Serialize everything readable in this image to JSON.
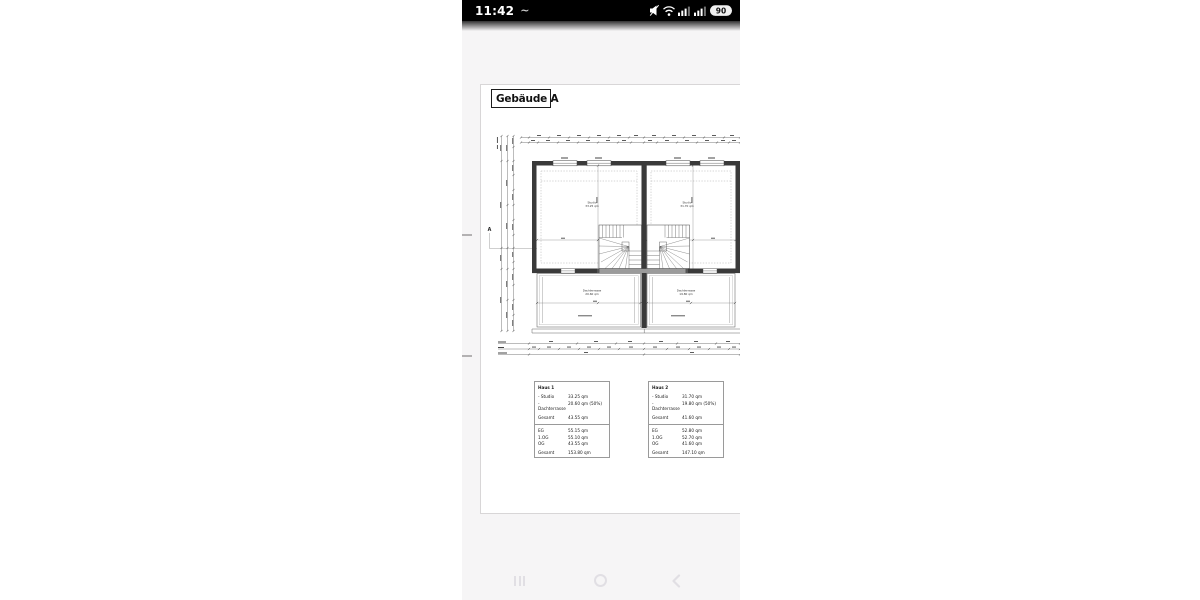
{
  "status_bar": {
    "time": "11:42",
    "wave": "~",
    "battery_percent": "90"
  },
  "page": {
    "title": "Gebäude A",
    "plan": {
      "section_label": "A",
      "rooms": {
        "studio_left": {
          "name": "Studio",
          "area": "33.25 qm"
        },
        "studio_right": {
          "name": "Studio",
          "area": "31.70 qm"
        },
        "terrace_left": {
          "name": "Dachterrasse",
          "area": "20.60 qm"
        },
        "terrace_right": {
          "name": "Dachterrasse",
          "area": "19.80 qm"
        }
      }
    },
    "tables": [
      {
        "title": "Haus 1",
        "rooms": [
          {
            "label": "- Studio",
            "value": "33.25 qm"
          },
          {
            "label": "- Dachterrasse",
            "value": "20.60 qm (50%)"
          }
        ],
        "rooms_total": {
          "label": "Gesamt",
          "value": "43.55 qm"
        },
        "floors": [
          {
            "label": "EG",
            "value": "55.15 qm"
          },
          {
            "label": "1.OG",
            "value": "55.10 qm"
          },
          {
            "label": "OG",
            "value": "43.55 qm"
          }
        ],
        "total": {
          "label": "Gesamt",
          "value": "153.80 qm"
        }
      },
      {
        "title": "Haus 2",
        "rooms": [
          {
            "label": "- Studio",
            "value": "31.70 qm"
          },
          {
            "label": "- Dachterrasse",
            "value": "19.80 qm (50%)"
          }
        ],
        "rooms_total": {
          "label": "Gesamt",
          "value": "41.60 qm"
        },
        "floors": [
          {
            "label": "EG",
            "value": "52.80 qm"
          },
          {
            "label": "1.OG",
            "value": "52.70 qm"
          },
          {
            "label": "OG",
            "value": "41.60 qm"
          }
        ],
        "total": {
          "label": "Gesamt",
          "value": "147.10 qm"
        }
      }
    ]
  }
}
